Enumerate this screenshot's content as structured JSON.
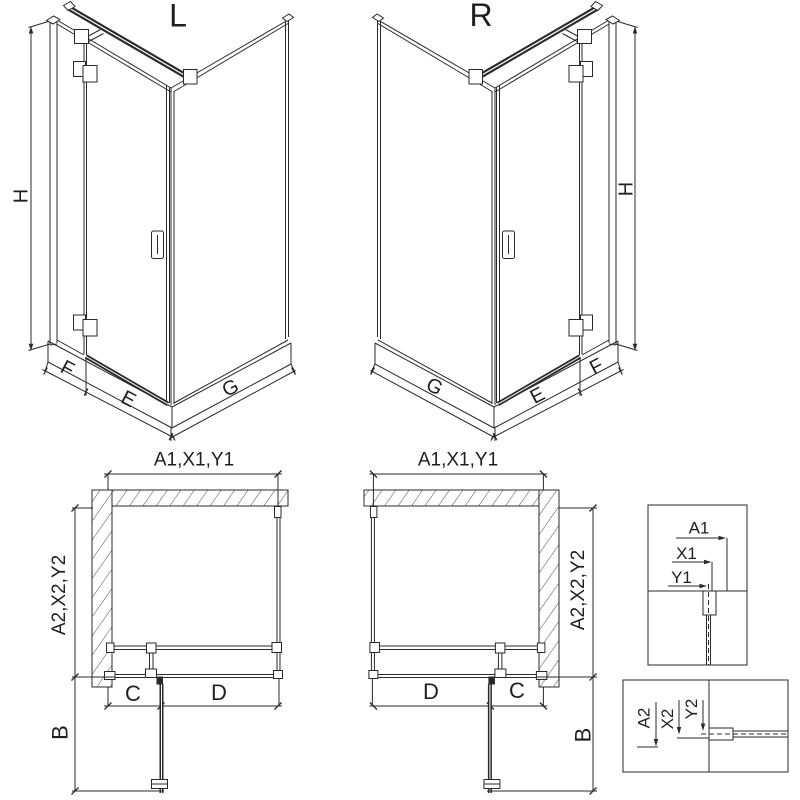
{
  "page": {
    "background": "#ffffff",
    "line_color": "#2a2a2a",
    "hatch_color": "#4a4a4a"
  },
  "iso_left": {
    "label": "L",
    "dim_height": "H",
    "dim_f": "F",
    "dim_e": "E",
    "dim_g": "G"
  },
  "iso_right": {
    "label": "R",
    "dim_height": "H",
    "dim_f": "F",
    "dim_e": "E",
    "dim_g": "G"
  },
  "plan_left": {
    "dim_top": "A1,X1,Y1",
    "dim_side": "A2,X2,Y2",
    "dim_c": "C",
    "dim_d": "D",
    "dim_b": "B"
  },
  "plan_right": {
    "dim_top": "A1,X1,Y1",
    "dim_side": "A2,X2,Y2",
    "dim_c": "C",
    "dim_d": "D",
    "dim_b": "B"
  },
  "detail_top": {
    "dim_a1": "A1",
    "dim_x1": "X1",
    "dim_y1": "Y1"
  },
  "detail_bottom": {
    "dim_a2": "A2",
    "dim_x2": "X2",
    "dim_y2": "Y2"
  }
}
